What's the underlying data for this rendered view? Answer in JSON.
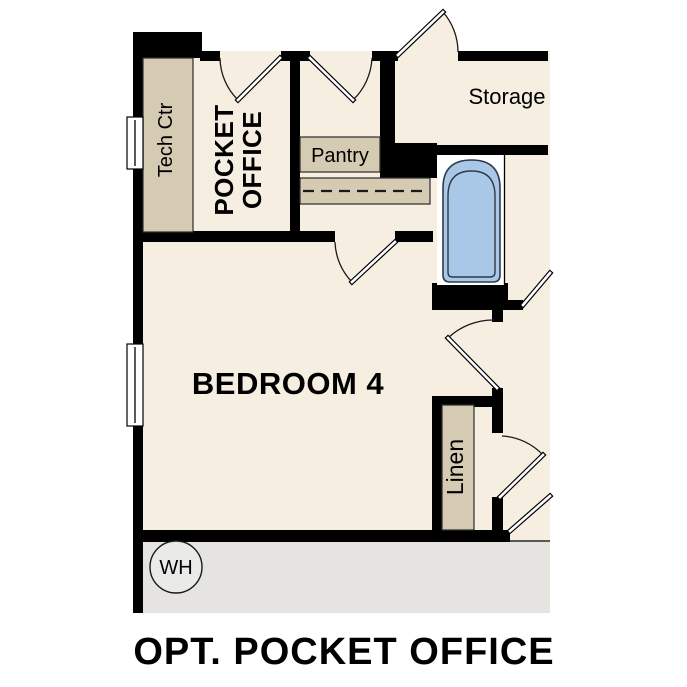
{
  "caption": "OPT. POCKET OFFICE",
  "rooms": {
    "tech_ctr": "Tech Ctr",
    "pocket_office_line1": "POCKET",
    "pocket_office_line2": "OFFICE",
    "pantry": "Pantry",
    "storage": "Storage",
    "bedroom": "BEDROOM 4",
    "linen": "Linen",
    "water_heater": "WH"
  },
  "colors": {
    "background": "#ffffff",
    "floor": "#f5eee1",
    "wall": "#000000",
    "counter": "#d5cab2",
    "garage_floor": "#e5e4e1",
    "tub_fill": "#a9c8e8",
    "window_fill": "#ffffff",
    "rod_dash": "#1a1a1a"
  }
}
